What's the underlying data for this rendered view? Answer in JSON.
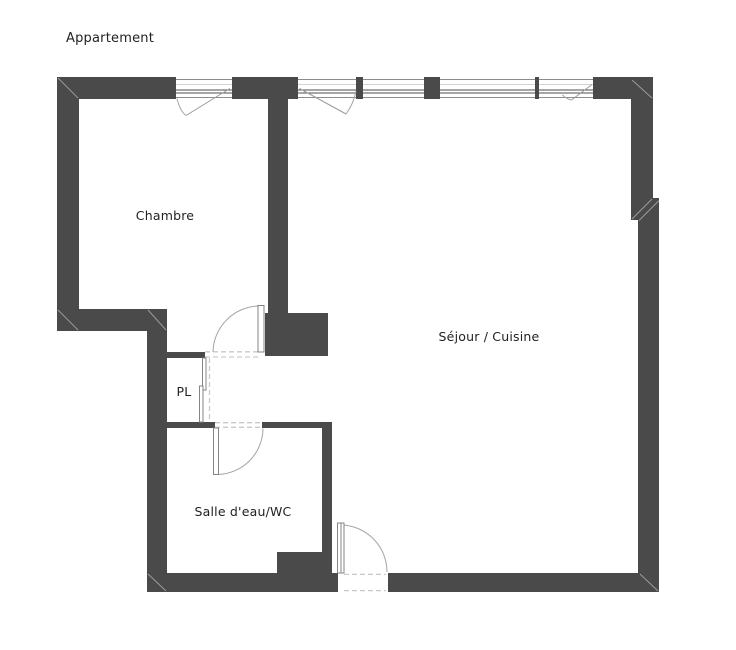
{
  "title": "Appartement",
  "rooms": {
    "chambre": {
      "label": "Chambre"
    },
    "sejour_cuisine": {
      "label": "Séjour / Cuisine"
    },
    "placard": {
      "label": "PL"
    },
    "salle_eau_wc": {
      "label": "Salle d'eau/WC"
    }
  },
  "features": {
    "windows_count": 5,
    "doors": [
      "chambre-door",
      "bathroom-door",
      "closet-sliding-door",
      "entry-door"
    ]
  },
  "colors": {
    "wall": "#4a4a4a",
    "line-light": "#9b9b9b",
    "dash": "#c9c9c9",
    "text": "#222222",
    "background": "#ffffff"
  }
}
